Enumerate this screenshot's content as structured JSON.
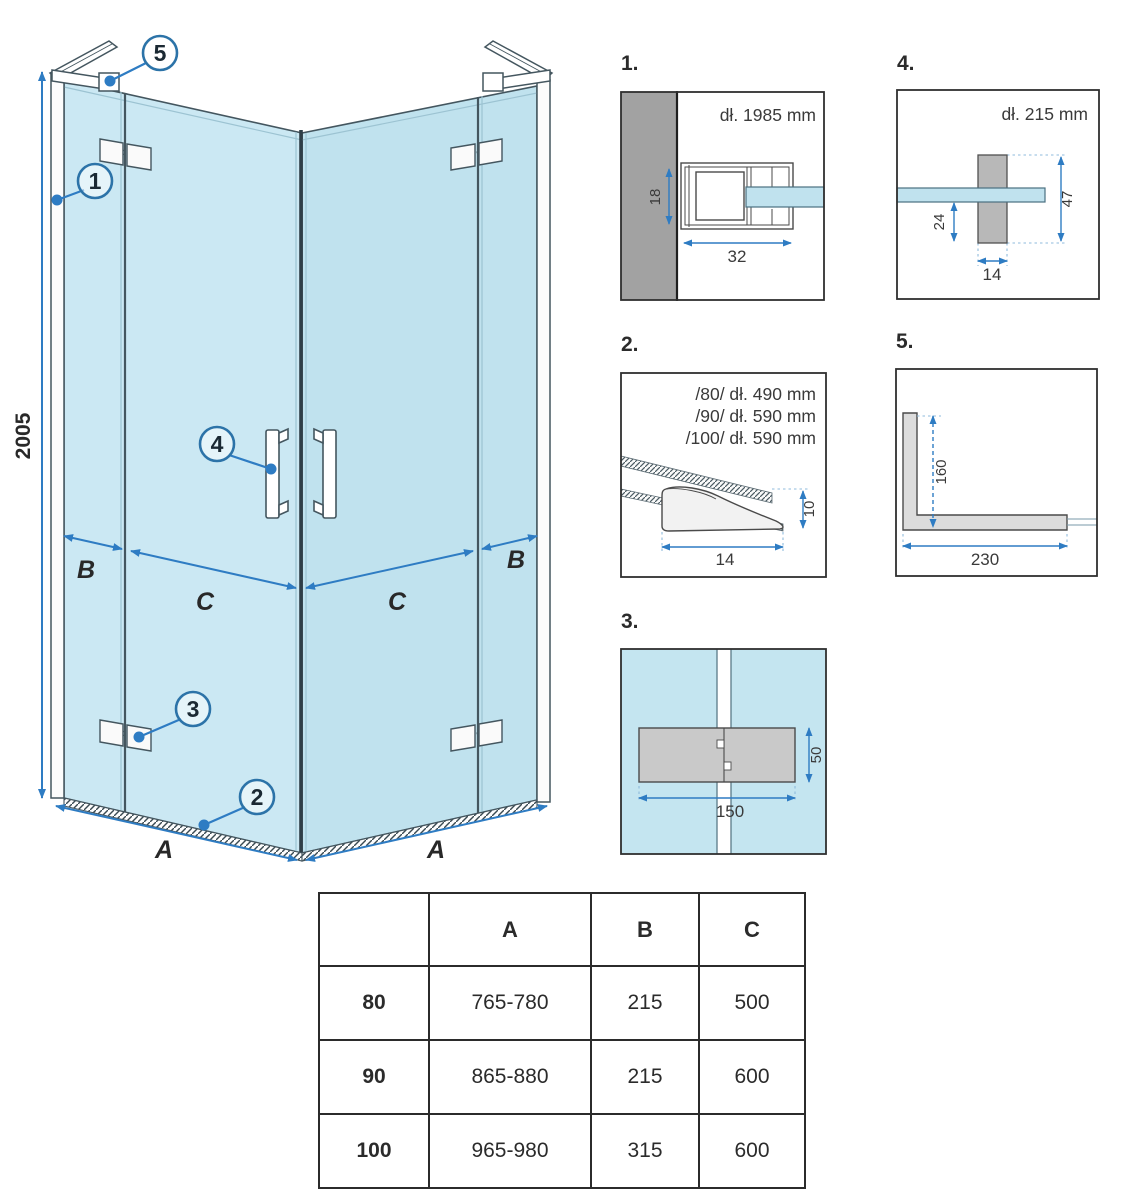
{
  "colors": {
    "accent_blue": "#2e7cc3",
    "callout_ring_blue": "#2c73a8",
    "glass_blue_light": "#cbe8f3",
    "glass_blue": "#c0e2ee",
    "wall_gray": "#a2a2a2",
    "part_gray": "#c9c9c9",
    "outline_dark": "#44565f",
    "table_border": "#2b2b2b"
  },
  "main_diagram": {
    "height_dim": "2005",
    "dim_a": "A",
    "dim_b": "B",
    "dim_c": "C",
    "callouts": {
      "c1": "1",
      "c2": "2",
      "c3": "3",
      "c4": "4",
      "c5": "5"
    }
  },
  "detail_1": {
    "label": "1.",
    "length": "dł. 1985 mm",
    "dim_height": "18",
    "dim_width": "32"
  },
  "detail_2": {
    "label": "2.",
    "line_80": "/80/ dł. 490 mm",
    "line_90": "/90/ dł. 590 mm",
    "line_100": "/100/ dł. 590 mm",
    "dim_height": "10",
    "dim_width": "14"
  },
  "detail_3": {
    "label": "3.",
    "dim_width": "150",
    "dim_height": "50"
  },
  "detail_4": {
    "label": "4.",
    "length": "dł. 215 mm",
    "dim_offset": "24",
    "dim_height": "47",
    "dim_width": "14"
  },
  "detail_5": {
    "label": "5.",
    "dim_vertical": "160",
    "dim_horizontal": "230"
  },
  "table": {
    "col_a": "A",
    "col_b": "B",
    "col_c": "C",
    "rows": [
      {
        "size": "80",
        "a": "765-780",
        "b": "215",
        "c": "500"
      },
      {
        "size": "90",
        "a": "865-880",
        "b": "215",
        "c": "600"
      },
      {
        "size": "100",
        "a": "965-980",
        "b": "315",
        "c": "600"
      }
    ]
  }
}
